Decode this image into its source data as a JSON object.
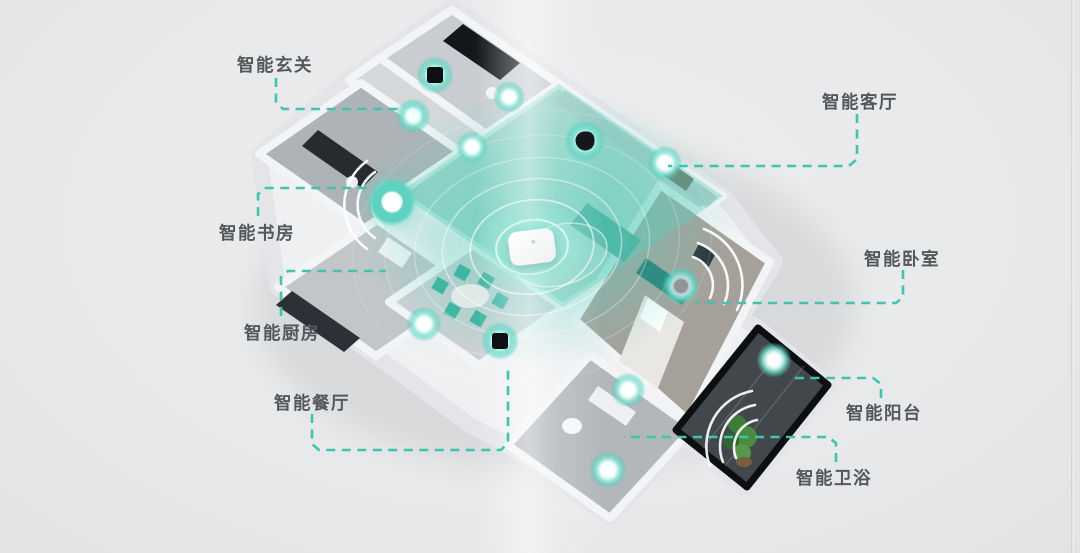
{
  "scene": {
    "name": "smart-home-isometric-floorplan",
    "description": "3D smart apartment with connected devices and central gateway"
  },
  "palette": {
    "accent": "#3fc4af",
    "device_glow": "#6fd9c7",
    "label_color": "#54585c",
    "background": "#e9eaec",
    "balcony_dark": "#15181b"
  },
  "callouts": [
    {
      "id": "entry",
      "label": "智能玄关",
      "x": 237,
      "y": 52,
      "line": "276,78 276,102 283,109 404,109"
    },
    {
      "id": "living",
      "label": "智能客厅",
      "x": 822,
      "y": 89,
      "line": "857,114 857,159 849,166 668,166"
    },
    {
      "id": "study",
      "label": "智能书房",
      "x": 219,
      "y": 220,
      "line": "258,216 258,194 265,188 370,188"
    },
    {
      "id": "kitchen",
      "label": "智能厨房",
      "x": 244,
      "y": 320,
      "line": "281,316 281,277 288,271 386,271"
    },
    {
      "id": "dining",
      "label": "智能餐厅",
      "x": 274,
      "y": 390,
      "line": "312,414 312,444 319,450 501,450 508,443 508,366"
    },
    {
      "id": "bedroom",
      "label": "智能卧室",
      "x": 864,
      "y": 246,
      "line": "903,270 903,297 896,303 696,303"
    },
    {
      "id": "balcony",
      "label": "智能阳台",
      "x": 846,
      "y": 400,
      "line": "881,398 881,384 873,378 790,378"
    },
    {
      "id": "bath",
      "label": "智能卫浴",
      "x": 796,
      "y": 465,
      "line": "836,462 836,443 828,437 624,437"
    }
  ],
  "devices": [
    {
      "name": "entry-wall-sensor",
      "type": "dark-square",
      "x": 435,
      "y": 75,
      "r": 13
    },
    {
      "name": "hallway-switch",
      "type": "glyph",
      "glyph": "H",
      "x": 413,
      "y": 116,
      "r": 12
    },
    {
      "name": "corridor-sensor",
      "type": "white-dot",
      "x": 509,
      "y": 97,
      "r": 11
    },
    {
      "name": "living-edge-sensor",
      "type": "white-dot",
      "x": 472,
      "y": 147,
      "r": 11
    },
    {
      "name": "living-camera",
      "type": "dark-blob",
      "x": 585,
      "y": 141,
      "r": 14
    },
    {
      "name": "living-wall-sensor",
      "type": "white-dot",
      "x": 665,
      "y": 163,
      "r": 12
    },
    {
      "name": "study-gateway-ring",
      "type": "donut",
      "x": 392,
      "y": 202,
      "r": 17
    },
    {
      "name": "kitchen-sensor",
      "type": "white-dot",
      "x": 424,
      "y": 324,
      "r": 12
    },
    {
      "name": "dining-sensor",
      "type": "dark-square",
      "x": 500,
      "y": 341,
      "r": 13
    },
    {
      "name": "bedroom-sensor",
      "type": "gray-circle",
      "x": 681,
      "y": 286,
      "r": 13
    },
    {
      "name": "balcony-light",
      "type": "white-dot",
      "x": 774,
      "y": 360,
      "r": 12
    },
    {
      "name": "bathroom-sensor",
      "type": "white-dot",
      "x": 628,
      "y": 390,
      "r": 12
    },
    {
      "name": "bathroom-light",
      "type": "white-dot",
      "x": 608,
      "y": 470,
      "r": 13
    },
    {
      "name": "central-hub",
      "type": "hub",
      "x": 532,
      "y": 247,
      "w": 46,
      "h": 34
    }
  ]
}
